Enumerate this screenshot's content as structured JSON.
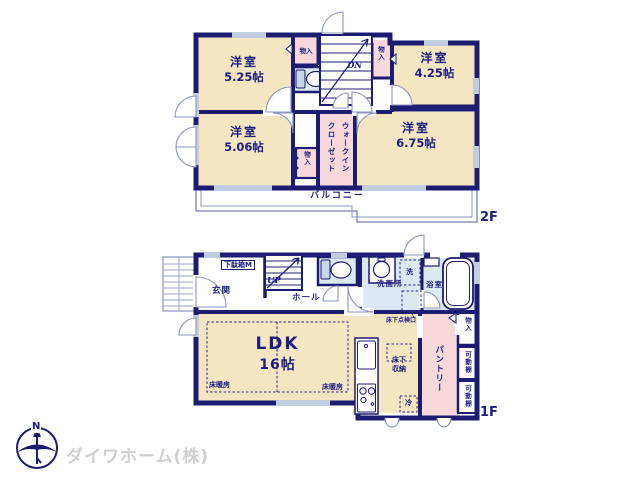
{
  "palette": {
    "wall": "#1c1c70",
    "text": "#1c1c82",
    "room_cream": "#f5e6c2",
    "closet_pink": "#f8d8da",
    "wet_blue": "#dce8f2",
    "light_line": "#8a94c0"
  },
  "floor2": {
    "floor_label": "2F",
    "rooms": [
      {
        "name": "洋室",
        "size": "5.25帖"
      },
      {
        "name": "洋室",
        "size": "4.25帖"
      },
      {
        "name": "洋室",
        "size": "5.06帖"
      },
      {
        "name": "洋室",
        "size": "6.75帖"
      }
    ],
    "walk_in_closet": "ウォークインクローゼット",
    "storage": "物入",
    "stairs_down": "DN",
    "balcony": "バルコニー"
  },
  "floor1": {
    "floor_label": "1F",
    "entrance": "玄関",
    "shoe_box": "下駄箱M",
    "stairs_up": "UP",
    "hall": "ホール",
    "washroom": "洗面所",
    "washer": "洗",
    "bathroom": "浴室",
    "underfloor_access": "床下点検口",
    "ldk_name": "LDK",
    "ldk_size": "16帖",
    "floor_heating": "床暖房",
    "underfloor_storage": "床下収納",
    "fridge": "冷",
    "pantry": "パントリー",
    "storage": "物入",
    "shelf": "可動棚"
  },
  "footer": {
    "company": "ダイワホーム(株)",
    "compass_north": "N"
  }
}
